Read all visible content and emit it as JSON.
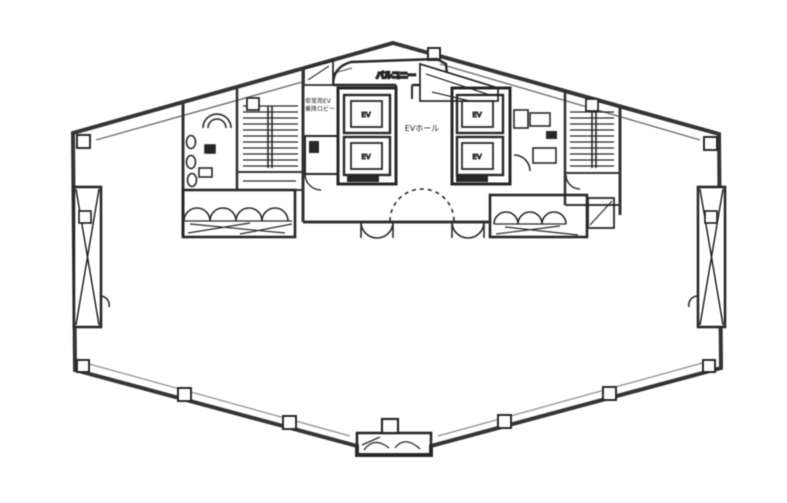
{
  "labels": {
    "balcony": "バルコニー",
    "hall": "EVホール",
    "ev1": "EV",
    "ev2": "EV",
    "ev3": "EV",
    "ev4": "EV",
    "lobby_line1": "非常用EV",
    "lobby_line2": "乗降ロビー"
  },
  "colors": {
    "ink": "#2e2e2e",
    "wall": "#3a3a3a",
    "light": "#8a8a8a",
    "paper": "#ffffff"
  }
}
